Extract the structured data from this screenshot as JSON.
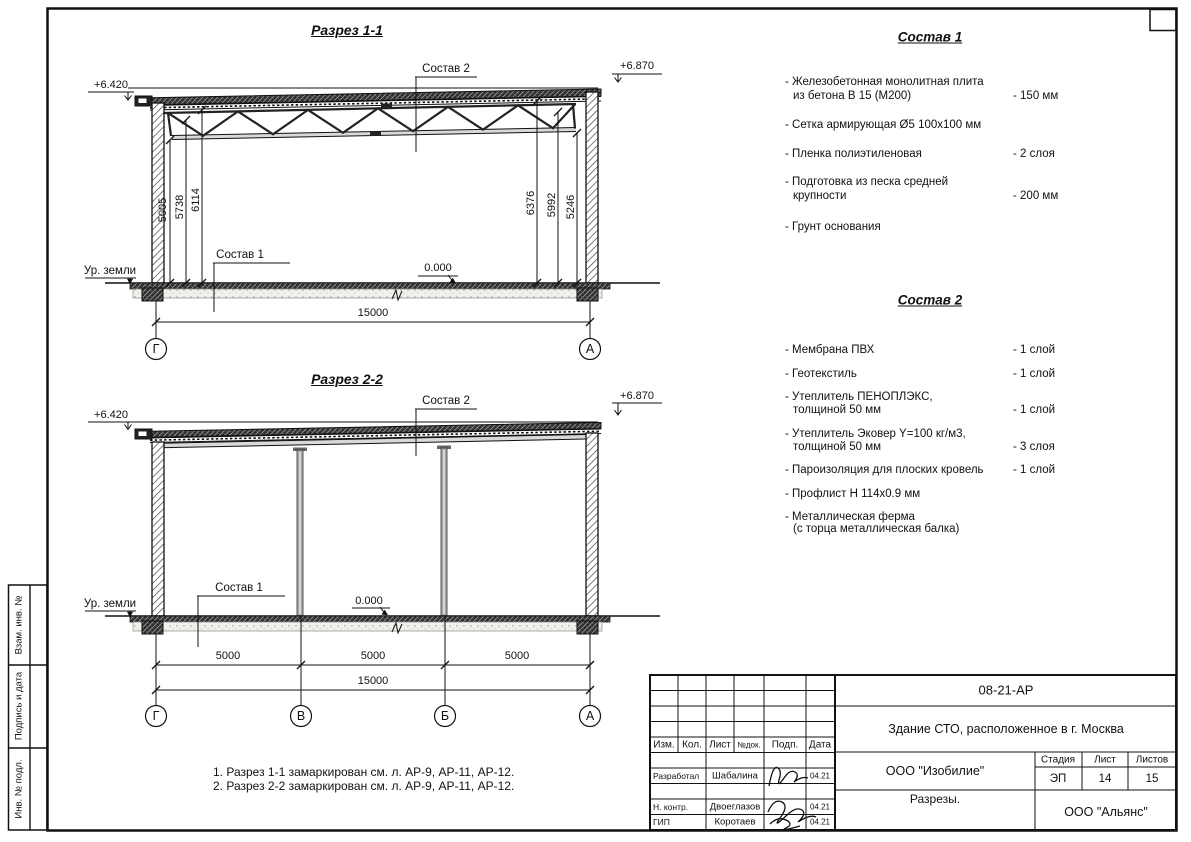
{
  "page": {
    "side_strip": {
      "items": [
        "Взам. инв. №",
        "Подпись и дата",
        "Инв. № подл."
      ]
    },
    "sections": [
      {
        "title": "Разрез 1-1",
        "elev_left": "+6.420",
        "elev_right": "+6.870",
        "leader_top": "Состав 2",
        "leader_bottom": "Состав 1",
        "zero_mark": "0.000",
        "ground": "Ур. земли",
        "dims_left": [
          "5005",
          "5738",
          "6114"
        ],
        "dims_right": [
          "6376",
          "5992",
          "5246"
        ],
        "dim_total": "15000",
        "axes": [
          "Г",
          "А"
        ]
      },
      {
        "title": "Разрез 2-2",
        "elev_left": "+6.420",
        "elev_right": "+6.870",
        "leader_top": "Состав 2",
        "leader_bottom": "Состав 1",
        "zero_mark": "0.000",
        "ground": "Ур. земли",
        "dims_segments": [
          "5000",
          "5000",
          "5000"
        ],
        "dim_total": "15000",
        "axes": [
          "Г",
          "В",
          "Б",
          "А"
        ]
      }
    ],
    "compositions": [
      {
        "title": "Состав 1",
        "items": [
          {
            "line1": "- Железобетонная  монолитная плита",
            "line2": "из бетона В 15 (М200)",
            "value": "- 150 мм"
          },
          {
            "line1": "- Сетка армирующая Ø5 100x100 мм",
            "line2": "",
            "value": ""
          },
          {
            "line1": "- Пленка полиэтиленовая",
            "line2": "",
            "value": "-  2 слоя"
          },
          {
            "line1": "- Подготовка из песка средней",
            "line2": "крупности",
            "value": "- 200 мм"
          },
          {
            "line1": "- Грунт основания",
            "line2": "",
            "value": ""
          }
        ]
      },
      {
        "title": "Состав 2",
        "items": [
          {
            "line1": "- Мембрана ПВХ",
            "line2": "",
            "value": "- 1 слой"
          },
          {
            "line1": "- Геотекстиль",
            "line2": "",
            "value": "- 1 слой"
          },
          {
            "line1": "- Утеплитель ПЕНОПЛЭКС,",
            "line2": "толщиной 50 мм",
            "value": "- 1 слой"
          },
          {
            "line1": "- Утеплитель Эковер Y=100 кг/м3,",
            "line2": "толщиной 50 мм",
            "value": "- 3 слоя"
          },
          {
            "line1": "- Пароизоляция для плоских кровель",
            "line2": "",
            "value": "- 1 слой"
          },
          {
            "line1": "- Профлист Н 114x0.9 мм",
            "line2": "",
            "value": ""
          },
          {
            "line1": "- Металлическая ферма",
            "line2": "(с торца металлическая балка)",
            "value": ""
          }
        ]
      }
    ],
    "notes": [
      "1. Разрез 1-1 замаркирован см. л. АР-9, АР-11, АР-12.",
      "2. Разрез 2-2 замаркирован см. л. АР-9, АР-11, АР-12."
    ],
    "stamp": {
      "doc_number": "08-21-АР",
      "project": "Здание СТО, расположенное в г. Москва",
      "designer_org": "ООО \"Изобилие\"",
      "sheet_name": "Разрезы.",
      "contractor_org": "ООО \"Альянс\"",
      "stage_label": "Стадия",
      "sheet_label": "Лист",
      "sheets_label": "Листов",
      "stage": "ЭП",
      "sheet": "14",
      "sheets": "15",
      "header_cols": [
        "Изм.",
        "Кол.",
        "Лист",
        "№док.",
        "Подп.",
        "Дата"
      ],
      "rows": [
        {
          "role": "Разработал",
          "name": "Шабалина",
          "date": "04.21"
        },
        {
          "role": "Н. контр.",
          "name": "Двоеглазов",
          "date": "04.21"
        },
        {
          "role": "ГИП",
          "name": "Коротаев",
          "date": "04.21"
        }
      ]
    }
  }
}
